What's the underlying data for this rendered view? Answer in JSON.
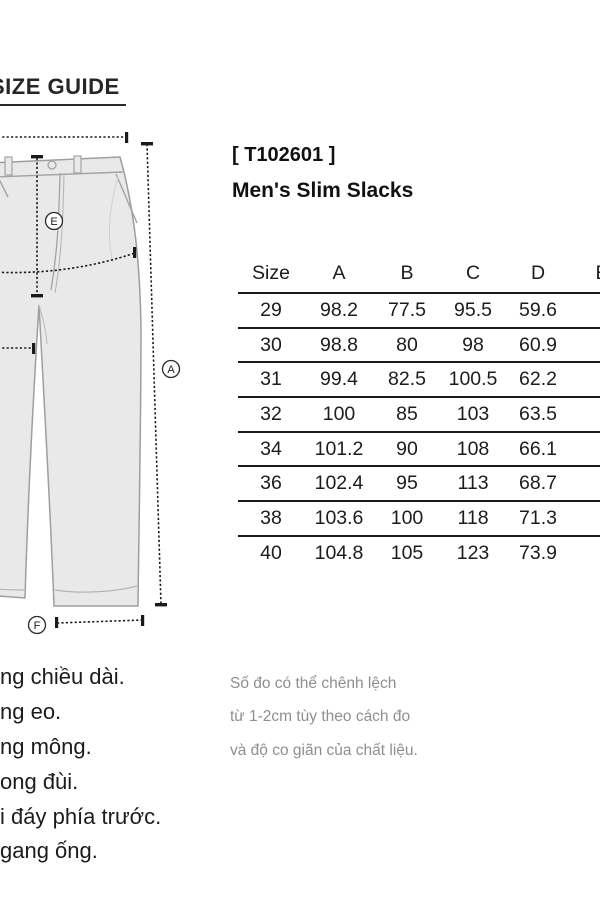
{
  "page": {
    "title": "SIZE GUIDE"
  },
  "product": {
    "code": "[ T102601 ]",
    "name": "Men's Slim Slacks"
  },
  "size_table": {
    "header": [
      "Size",
      "A",
      "B",
      "C",
      "D",
      "E"
    ],
    "rows": [
      [
        "29",
        "98.2",
        "77.5",
        "95.5",
        "59.6",
        ""
      ],
      [
        "30",
        "98.8",
        "80",
        "98",
        "60.9",
        ""
      ],
      [
        "31",
        "99.4",
        "82.5",
        "100.5",
        "62.2",
        ""
      ],
      [
        "32",
        "100",
        "85",
        "103",
        "63.5",
        ""
      ],
      [
        "34",
        "101.2",
        "90",
        "108",
        "66.1",
        ""
      ],
      [
        "36",
        "102.4",
        "95",
        "113",
        "68.7",
        ""
      ],
      [
        "38",
        "103.6",
        "100",
        "118",
        "71.3",
        ""
      ],
      [
        "40",
        "104.8",
        "105",
        "123",
        "73.9",
        ""
      ]
    ]
  },
  "diagram": {
    "labels": {
      "front_rise": "E",
      "length": "A",
      "hem": "F"
    }
  },
  "notes": {
    "measurements": [
      "ng chiều dài.",
      "ng eo.",
      "ng mông.",
      "ong đùi.",
      "i đáy phía trước.",
      "gang ống."
    ],
    "disclaimer": [
      "Số đo có thể chênh lệch",
      "từ 1-2cm tùy theo cách đo",
      "và độ co giãn của chất liệu."
    ]
  },
  "colors": {
    "text": "#1c1c1c",
    "muted_text": "#8f8f8f",
    "garment_fill": "#e9e9e9",
    "garment_line": "#9e9e9e",
    "measure_line": "#1a1a1a"
  }
}
